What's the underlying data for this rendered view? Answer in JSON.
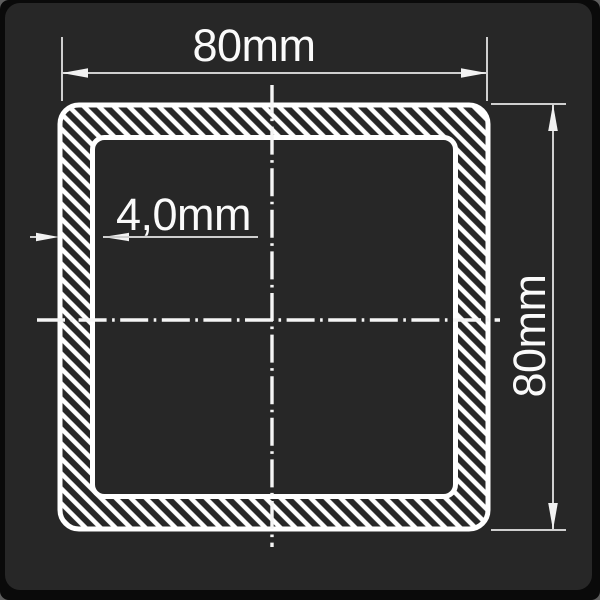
{
  "drawing": {
    "labels": {
      "outer_width": "80mm",
      "outer_height": "80mm",
      "wall_thickness": "4,0mm"
    }
  },
  "colors": {
    "page": "#5e5e5e",
    "frame": "#0a0a0a",
    "card": "#272727",
    "tube_line": "#ffffff",
    "dim_line": "#cfcfcf",
    "centerline": "#f5f5f5",
    "arrow": "#f2f2f2",
    "text": "#fafafa"
  }
}
